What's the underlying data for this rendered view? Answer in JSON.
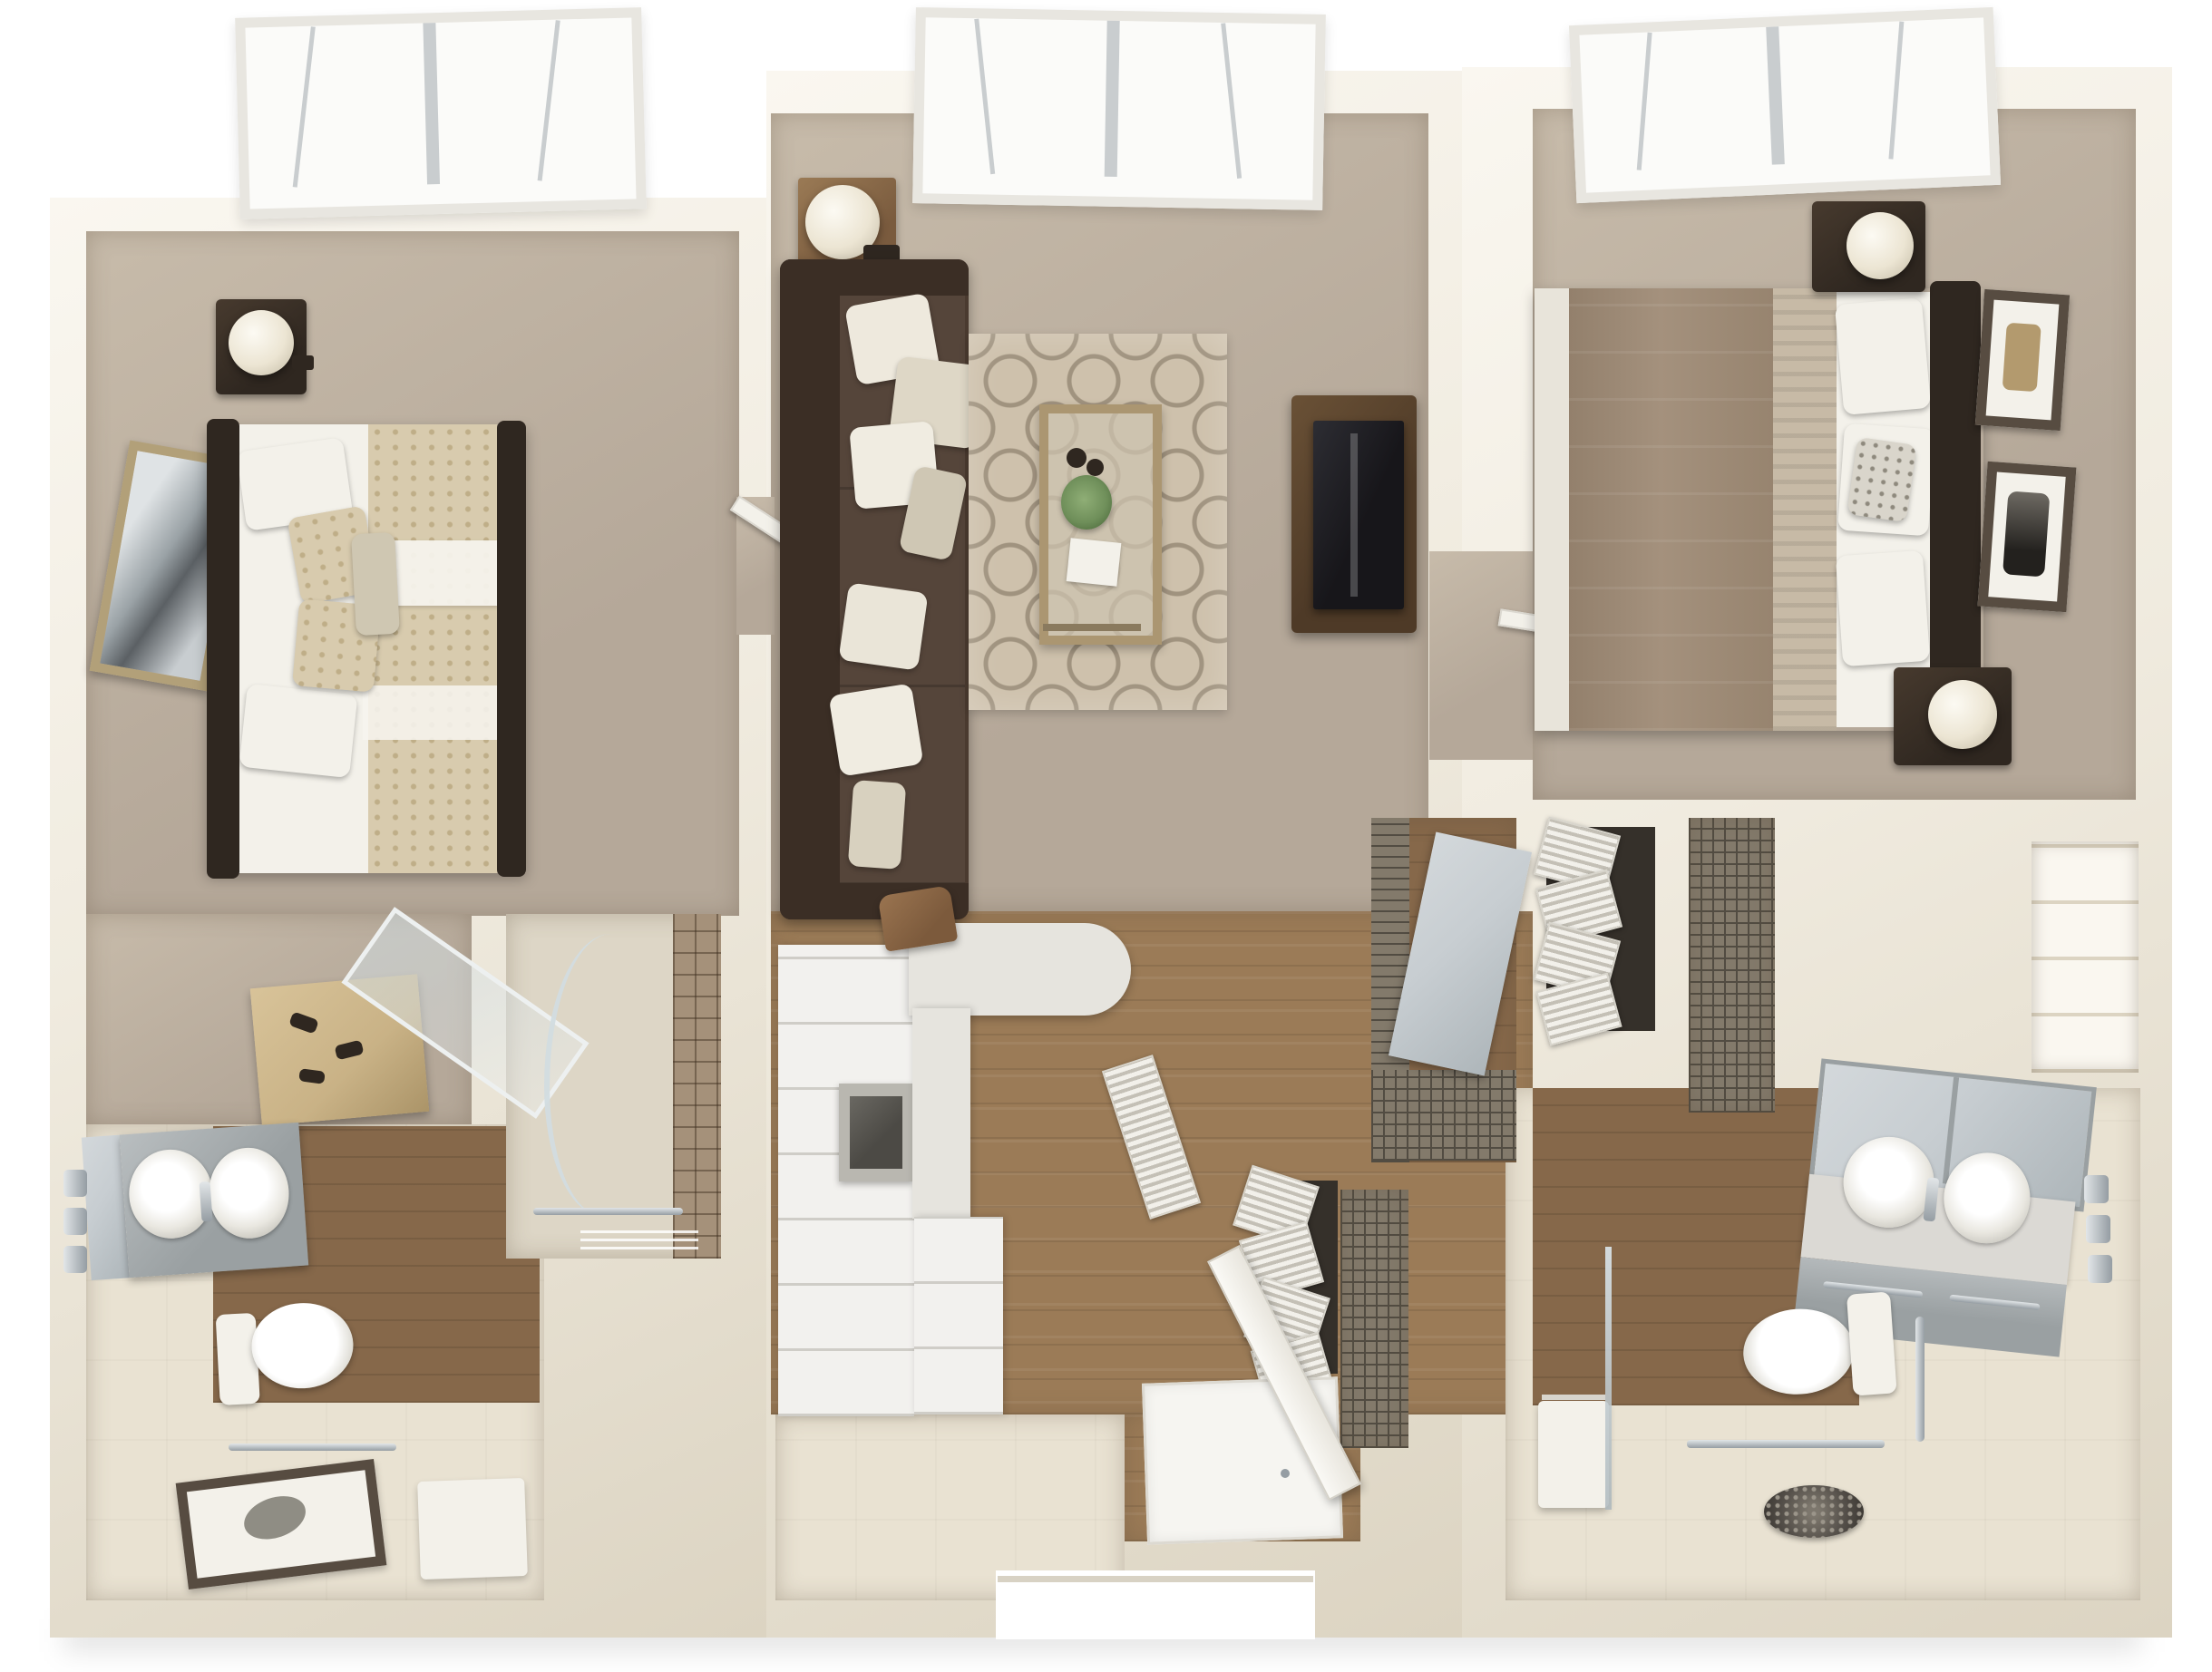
{
  "scene": {
    "type": "3d-floor-plan-render",
    "description": "Top-down 3D rendering of a two-bedroom, two-bathroom apartment floor plan with central living room, kitchen, entry hall and closets",
    "rooms": [
      {
        "id": "bedroom-1",
        "position": "top-left",
        "features": [
          "skylight-window",
          "bed",
          "patterned-comforter",
          "pillows",
          "headboard",
          "nightstand",
          "table-lamp",
          "leaning-mirror",
          "storage-chest"
        ]
      },
      {
        "id": "living-room",
        "position": "top-center",
        "features": [
          "skylight-window",
          "sofa",
          "throw-pillows",
          "side-table",
          "table-lamp",
          "trellis-area-rug",
          "coffee-table",
          "potted-plant",
          "tray",
          "tv-console",
          "flat-screen-tv"
        ]
      },
      {
        "id": "bedroom-2",
        "position": "top-right",
        "features": [
          "skylight-window",
          "bed",
          "duvet",
          "pillows",
          "headboard",
          "nightstand",
          "table-lamp",
          "framed-art",
          "framed-art"
        ]
      },
      {
        "id": "bathroom-1",
        "position": "bottom-left",
        "features": [
          "vanity-cabinet",
          "sink",
          "mirror",
          "towel-hooks",
          "toilet",
          "towel-bar",
          "framed-picture-on-floor",
          "walk-in-shower",
          "glass-shower-door",
          "grab-bar",
          "shower-seat"
        ]
      },
      {
        "id": "kitchen",
        "position": "bottom-center-left",
        "features": [
          "refrigerator",
          "tall-cabinets",
          "oven",
          "counter-peninsula",
          "bar-chair",
          "base-cabinet"
        ]
      },
      {
        "id": "entry-hall",
        "position": "bottom-center",
        "features": [
          "entry-door",
          "door-mat",
          "louvered-bifold-closet",
          "wire-shelf-closet",
          "utility-door"
        ]
      },
      {
        "id": "closet-zone",
        "position": "center-right",
        "features": [
          "walk-in-closet",
          "wire-shelving",
          "louvered-bifold-doors",
          "sliding-panel",
          "linen-shelves"
        ]
      },
      {
        "id": "bathroom-2",
        "position": "bottom-right",
        "features": [
          "vanity-cabinet",
          "double-sink",
          "mirror-cabinet",
          "towel-hooks",
          "toilet",
          "grab-bar",
          "towel-bar",
          "roll-in-shower",
          "mosaic-drain",
          "shower-bench",
          "glass-partition"
        ]
      }
    ]
  },
  "palette": {
    "page-bg": "#ffffff",
    "wall": "#f0ebdf",
    "wall-bright": "#faf7f0",
    "wall-shade": "#dcd4c2",
    "carpet": "#b5a899",
    "carpet-light": "#c7bbaa",
    "wood": "#9b7b57",
    "wood-dark": "#86684a",
    "tile": "#e9e2d2",
    "shower-floor": "#ddd6c6",
    "dark-furniture": "#2f2720",
    "sofa": "#4a3a2f",
    "sofa-dark": "#3b2e25",
    "sofa-seat": "#55453a",
    "bed1-spread": "#d8cbae",
    "bed1-accent": "#bfae88",
    "linen": "#f3f1ea",
    "bed2-spread": "#a4917d",
    "bed2-fold": "#c7baa6",
    "rug-base": "#cec1ac",
    "rug-line": "#a0937f",
    "lamp": "#ece5d3",
    "tv": "#17161a",
    "console": "#4e3a27",
    "counter": "#e6e4de",
    "cabinet": "#f2f1ee",
    "cabinet-line": "#cfcdc7",
    "gray-cabinet": "#9aa0a2",
    "chrome": "#959da3",
    "glassc": "#ccd5d9",
    "wire-bg": "#837a6b",
    "wire-line": "#524c42",
    "louver-hi": "#f2f0ea",
    "louver-lo": "#c4c0b6",
    "louver-gap": "#35302a",
    "window-frame": "#e8e6e0",
    "frame-gold": "#b2a079",
    "frame-dark": "#574c41",
    "mirror": "#c7cdd1",
    "plant": "#6f8f5a",
    "drain": "#55504a",
    "art": "#8f8d84",
    "wood-chest": "#c9b286"
  }
}
